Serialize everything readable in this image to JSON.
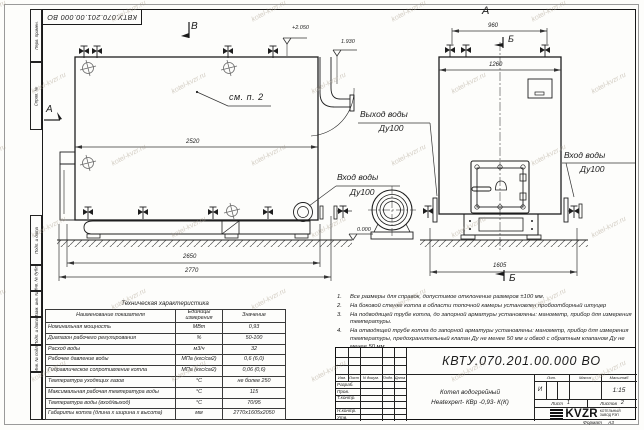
{
  "watermark": {
    "text": "kotel-kvzr.ru"
  },
  "frame": {
    "top_stamp": "КВТУ.070.201.00.000  ВО",
    "left_labels": [
      "Перв. примен.",
      "Справ. №",
      "Подп. и дата",
      "Инв. № дубл.",
      "Взам. инв. №",
      "Подп. и дата",
      "Инв. № подл."
    ]
  },
  "views": {
    "section_b_top": "В",
    "section_a_left": "А",
    "front_view_label": "А",
    "section_mark_top": "Б",
    "section_mark_bottom": "Б",
    "see_note": "см. п. 2",
    "elev_top": "+2.050",
    "elev_mid": "1.930",
    "elev_zero": "0.000",
    "dim_2520": "2520",
    "dim_2650": "2650",
    "dim_2770": "2770",
    "dim_960": "960",
    "dim_1260": "1260",
    "dim_1605": "1605",
    "outlet_label_1": "Выход воды",
    "outlet_label_2": "Ду100",
    "inlet_left_1": "Вход воды",
    "inlet_left_2": "Ду100",
    "inlet_right_1": "Вход воды",
    "inlet_right_2": "Ду100"
  },
  "notes": [
    {
      "num": "1.",
      "text": "Все размеры для справок, допустимое отклонение размеров ±100 мм."
    },
    {
      "num": "2.",
      "text": "На боковой стенке котла в области топочной камеры установлен пробоотборный штуцер"
    },
    {
      "num": "3.",
      "text": "На  подводящей трубе котла, до запорной арматуры установлены: манометр, прибор для измерения температуры."
    },
    {
      "num": "4.",
      "text": "На отводящей трубе котла до запорной арматуры установлены: манометр, прибор для измерения температуры, предохранительный клапан Ду не менее 50 мм и обвод с обратным клапаном Ду не менее 50 мм."
    }
  ],
  "spec_table": {
    "title": "Техническая характеристика",
    "headers": [
      "Наименование показателя",
      "Единицы измерения",
      "Значение"
    ],
    "rows": [
      {
        "name": "Номинальная мощность",
        "unit": "МВт",
        "value": "0,93"
      },
      {
        "name": "Диапазон рабочего регулирования",
        "unit": "%",
        "value": "50-100"
      },
      {
        "name": "Расход воды",
        "unit": "м3/ч",
        "value": "32"
      },
      {
        "name": "Рабочее давление воды",
        "unit": "МПа (кгс/см2)",
        "value": "0,6 (6,0)"
      },
      {
        "name": "Гидравлическое сопротивление котла",
        "unit": "МПа (кгс/см2)",
        "value": "0,06 (0,6)"
      },
      {
        "name": "Температура уходящих газов",
        "unit": "°С",
        "value": "не более 250"
      },
      {
        "name": "Максимальная рабочая температура воды",
        "unit": "°С",
        "value": "115"
      },
      {
        "name": "Температура воды (вход/выход)",
        "unit": "°С",
        "value": "70/95"
      },
      {
        "name": "Габариты котла (длина х ширина х высота)",
        "unit": "мм",
        "value": "2770х1605х2050"
      }
    ]
  },
  "title_block": {
    "doc_number": "КВТУ.070.201.00.000  ВО",
    "product_name_1": "Котел водогрейный",
    "product_name_2": "Heatexpert- КВр -0,93- К(К)",
    "col_izm": "Изм.",
    "col_list": "Лист",
    "col_ndoc": "N докум.",
    "col_podp": "Подп.",
    "col_data": "Дата",
    "row_labels": [
      "Разраб.",
      "Пров.",
      "Т.контр.",
      "",
      "Н.контр.",
      "Утв."
    ],
    "lit_header": "Лит.",
    "mass_header": "Масса",
    "scale_header": "Масштаб",
    "lit_value": "И",
    "scale_value": "1:15",
    "sheet_label": "Лист",
    "sheet_value": "1",
    "sheets_label": "Листов",
    "sheets_value": "2",
    "logo_text": "KVZR",
    "logo_caption_1": "КОТЕЛЬНЫЙ",
    "logo_caption_2": "ЗАВОД РЭП",
    "format_label": "Формат",
    "format_value": "А3"
  }
}
